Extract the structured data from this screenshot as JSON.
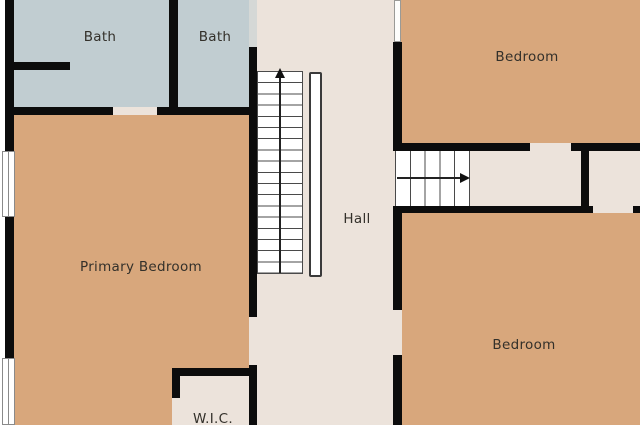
{
  "floorplan": {
    "title": "Upper floor plan",
    "rooms": {
      "bath_left": {
        "label": "Bath"
      },
      "bath_right": {
        "label": "Bath"
      },
      "bedroom_top": {
        "label": "Bedroom"
      },
      "primary_bedroom": {
        "label": "Primary Bedroom"
      },
      "hall": {
        "label": "Hall"
      },
      "bedroom_bottom": {
        "label": "Bedroom"
      },
      "wic": {
        "label": "W.I.C."
      }
    },
    "stairs": {
      "main": {
        "direction": "up",
        "steps": 18,
        "arrow_icon": "stairs-up-arrow-icon"
      },
      "secondary": {
        "direction": "right",
        "steps": 5,
        "arrow_icon": "stairs-right-arrow-icon"
      }
    },
    "features": {
      "windows_left_wall": 2,
      "railing": "main-staircase-right-side"
    },
    "colors": {
      "bedroom_fill": "#d8a77c",
      "bath_fill": "#c1cdd1",
      "hall_fill": "#ece3db",
      "wall": "#0c0c0c",
      "window": "#ffffff",
      "door_segment_gray": "#d5d8d6",
      "label_text": "#33302a"
    }
  }
}
